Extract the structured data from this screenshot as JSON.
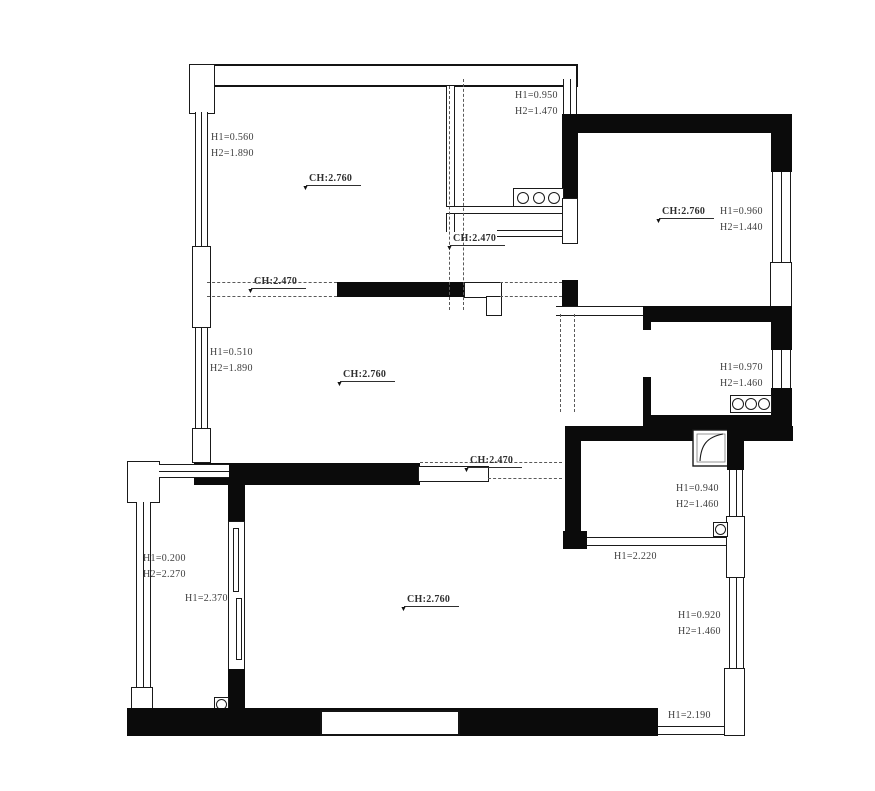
{
  "drawing": {
    "type": "floor-plan",
    "wall_color": "#0b0b0b",
    "line_color": "#1a1a1a",
    "text_color": "#3d3d3d",
    "background": "#ffffff"
  },
  "annotations": {
    "ceiling_height_markers": [
      {
        "text": "CH:2.760",
        "x": 306,
        "y": 173
      },
      {
        "text": "CH:2.470",
        "x": 251,
        "y": 276
      },
      {
        "text": "CH:2.470",
        "x": 450,
        "y": 233
      },
      {
        "text": "CH:2.760",
        "x": 659,
        "y": 206
      },
      {
        "text": "CH:2.760",
        "x": 340,
        "y": 369
      },
      {
        "text": "CH:2.470",
        "x": 467,
        "y": 455
      },
      {
        "text": "CH:2.760",
        "x": 404,
        "y": 594
      }
    ],
    "dimension_labels": [
      {
        "lines": [
          "H1=0.560",
          "H2=1.890"
        ],
        "x": 211,
        "y": 130
      },
      {
        "lines": [
          "H1=0.950",
          "H2=1.470"
        ],
        "x": 515,
        "y": 88
      },
      {
        "lines": [
          "H1=0.960",
          "H2=1.440"
        ],
        "x": 720,
        "y": 204
      },
      {
        "lines": [
          "H1=0.970",
          "H2=1.460"
        ],
        "x": 720,
        "y": 360
      },
      {
        "lines": [
          "H1=0.510",
          "H2=1.890"
        ],
        "x": 210,
        "y": 345
      },
      {
        "lines": [
          "H1=0.940",
          "H2=1.460"
        ],
        "x": 676,
        "y": 481
      },
      {
        "lines": [
          "H1=2.220"
        ],
        "x": 614,
        "y": 549
      },
      {
        "lines": [
          "H1=0.200",
          "H2=2.270"
        ],
        "x": 143,
        "y": 551
      },
      {
        "lines": [
          "H1=2.370"
        ],
        "x": 185,
        "y": 591
      },
      {
        "lines": [
          "H1=0.920",
          "H2=1.460"
        ],
        "x": 678,
        "y": 608
      },
      {
        "lines": [
          "H1=2.190"
        ],
        "x": 668,
        "y": 708
      }
    ],
    "symbols": [
      {
        "name": "cooktop-burners",
        "count": 3,
        "location": "kitchen-top"
      },
      {
        "name": "cooktop-burners",
        "count": 3,
        "location": "room-middle-right"
      },
      {
        "name": "shower-tray",
        "location": "bathroom"
      },
      {
        "name": "floor-drain",
        "location": "bathroom"
      },
      {
        "name": "floor-drain",
        "location": "balcony"
      }
    ]
  }
}
